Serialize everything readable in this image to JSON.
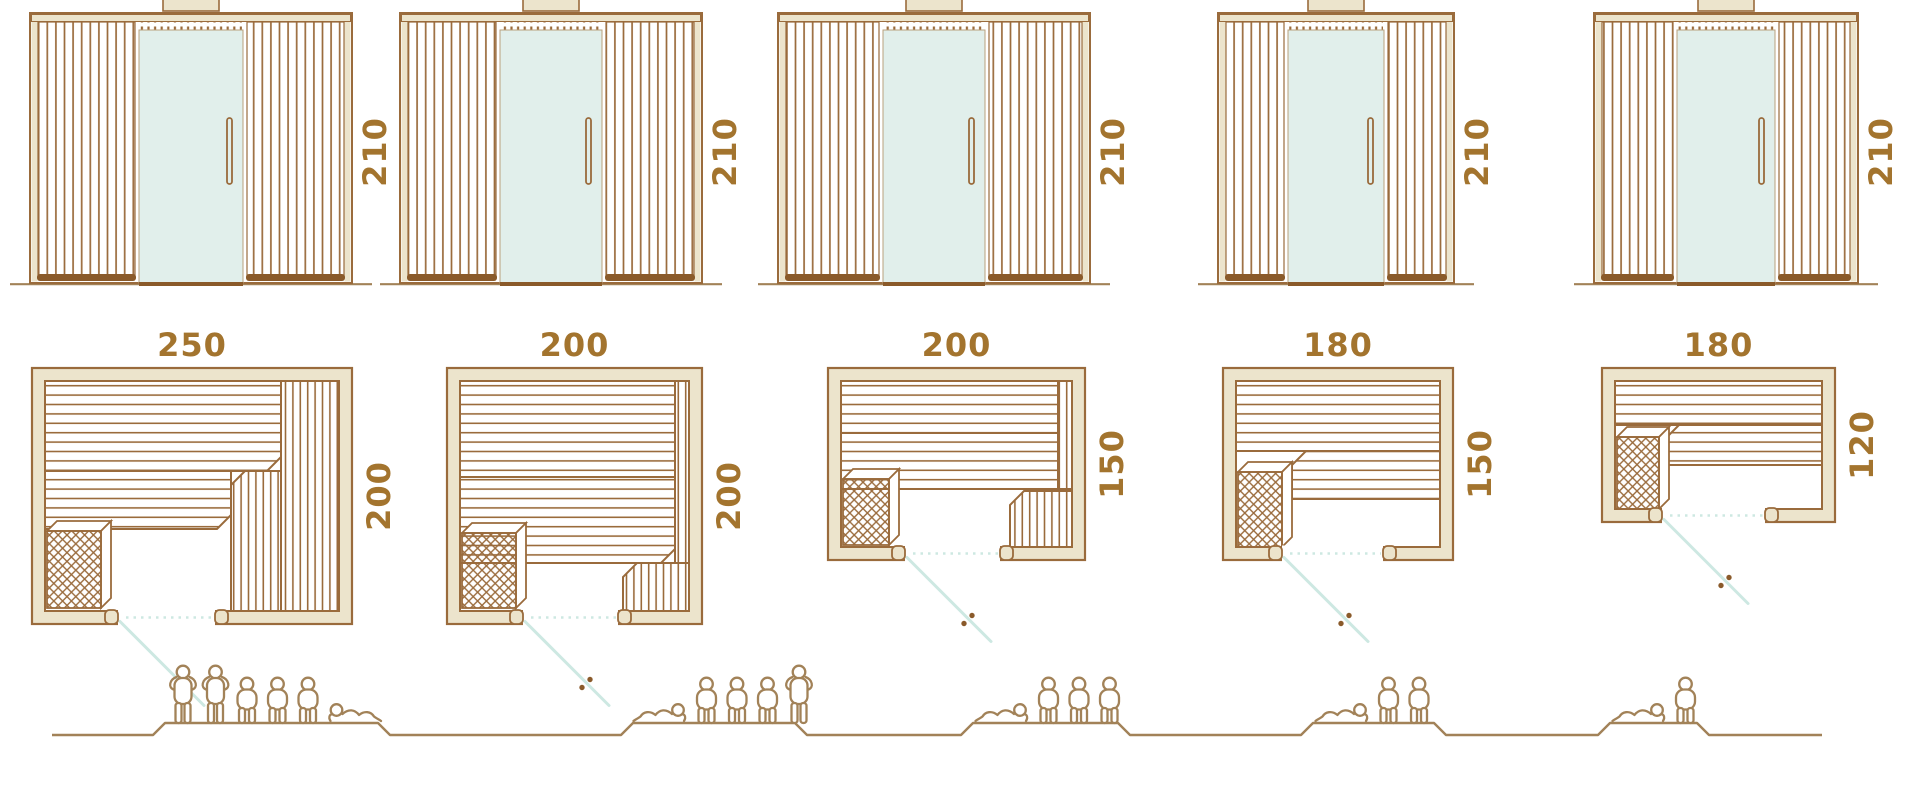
{
  "diagram": {
    "kind": "sauna size comparison",
    "rows": [
      "front elevations",
      "floor plans",
      "seating capacity figures"
    ]
  },
  "colors": {
    "outline": "#9a6b3c",
    "outline_dark": "#8a5a2a",
    "wall_fill": "#ece4cc",
    "glass": "#e1efeb",
    "glass_edge": "#b9a27e",
    "swing_line": "#cde8e2",
    "dimension_text": "#a3742e",
    "people": "#a28258"
  },
  "units": [
    {
      "name": "sauna-250x200",
      "elevation": {
        "height_label": "210"
      },
      "plan": {
        "width_label": "250",
        "depth_label": "200"
      },
      "capacity": {
        "count": 6,
        "figures": [
          "standing",
          "standing",
          "sitting",
          "sitting",
          "sitting",
          "lying"
        ]
      }
    },
    {
      "name": "sauna-200x200",
      "elevation": {
        "height_label": "210"
      },
      "plan": {
        "width_label": "200",
        "depth_label": "200"
      },
      "capacity": {
        "count": 5,
        "figures": [
          "lying",
          "sitting",
          "sitting",
          "sitting",
          "standing"
        ]
      }
    },
    {
      "name": "sauna-200x150",
      "elevation": {
        "height_label": "210"
      },
      "plan": {
        "width_label": "200",
        "depth_label": "150"
      },
      "capacity": {
        "count": 4,
        "figures": [
          "lying",
          "sitting",
          "sitting",
          "sitting"
        ]
      }
    },
    {
      "name": "sauna-180x150",
      "elevation": {
        "height_label": "210"
      },
      "plan": {
        "width_label": "180",
        "depth_label": "150"
      },
      "capacity": {
        "count": 3,
        "figures": [
          "lying",
          "sitting",
          "sitting"
        ]
      }
    },
    {
      "name": "sauna-180x120",
      "elevation": {
        "height_label": "210"
      },
      "plan": {
        "width_label": "180",
        "depth_label": "120"
      },
      "capacity": {
        "count": 2,
        "figures": [
          "lying",
          "sitting"
        ]
      }
    }
  ]
}
